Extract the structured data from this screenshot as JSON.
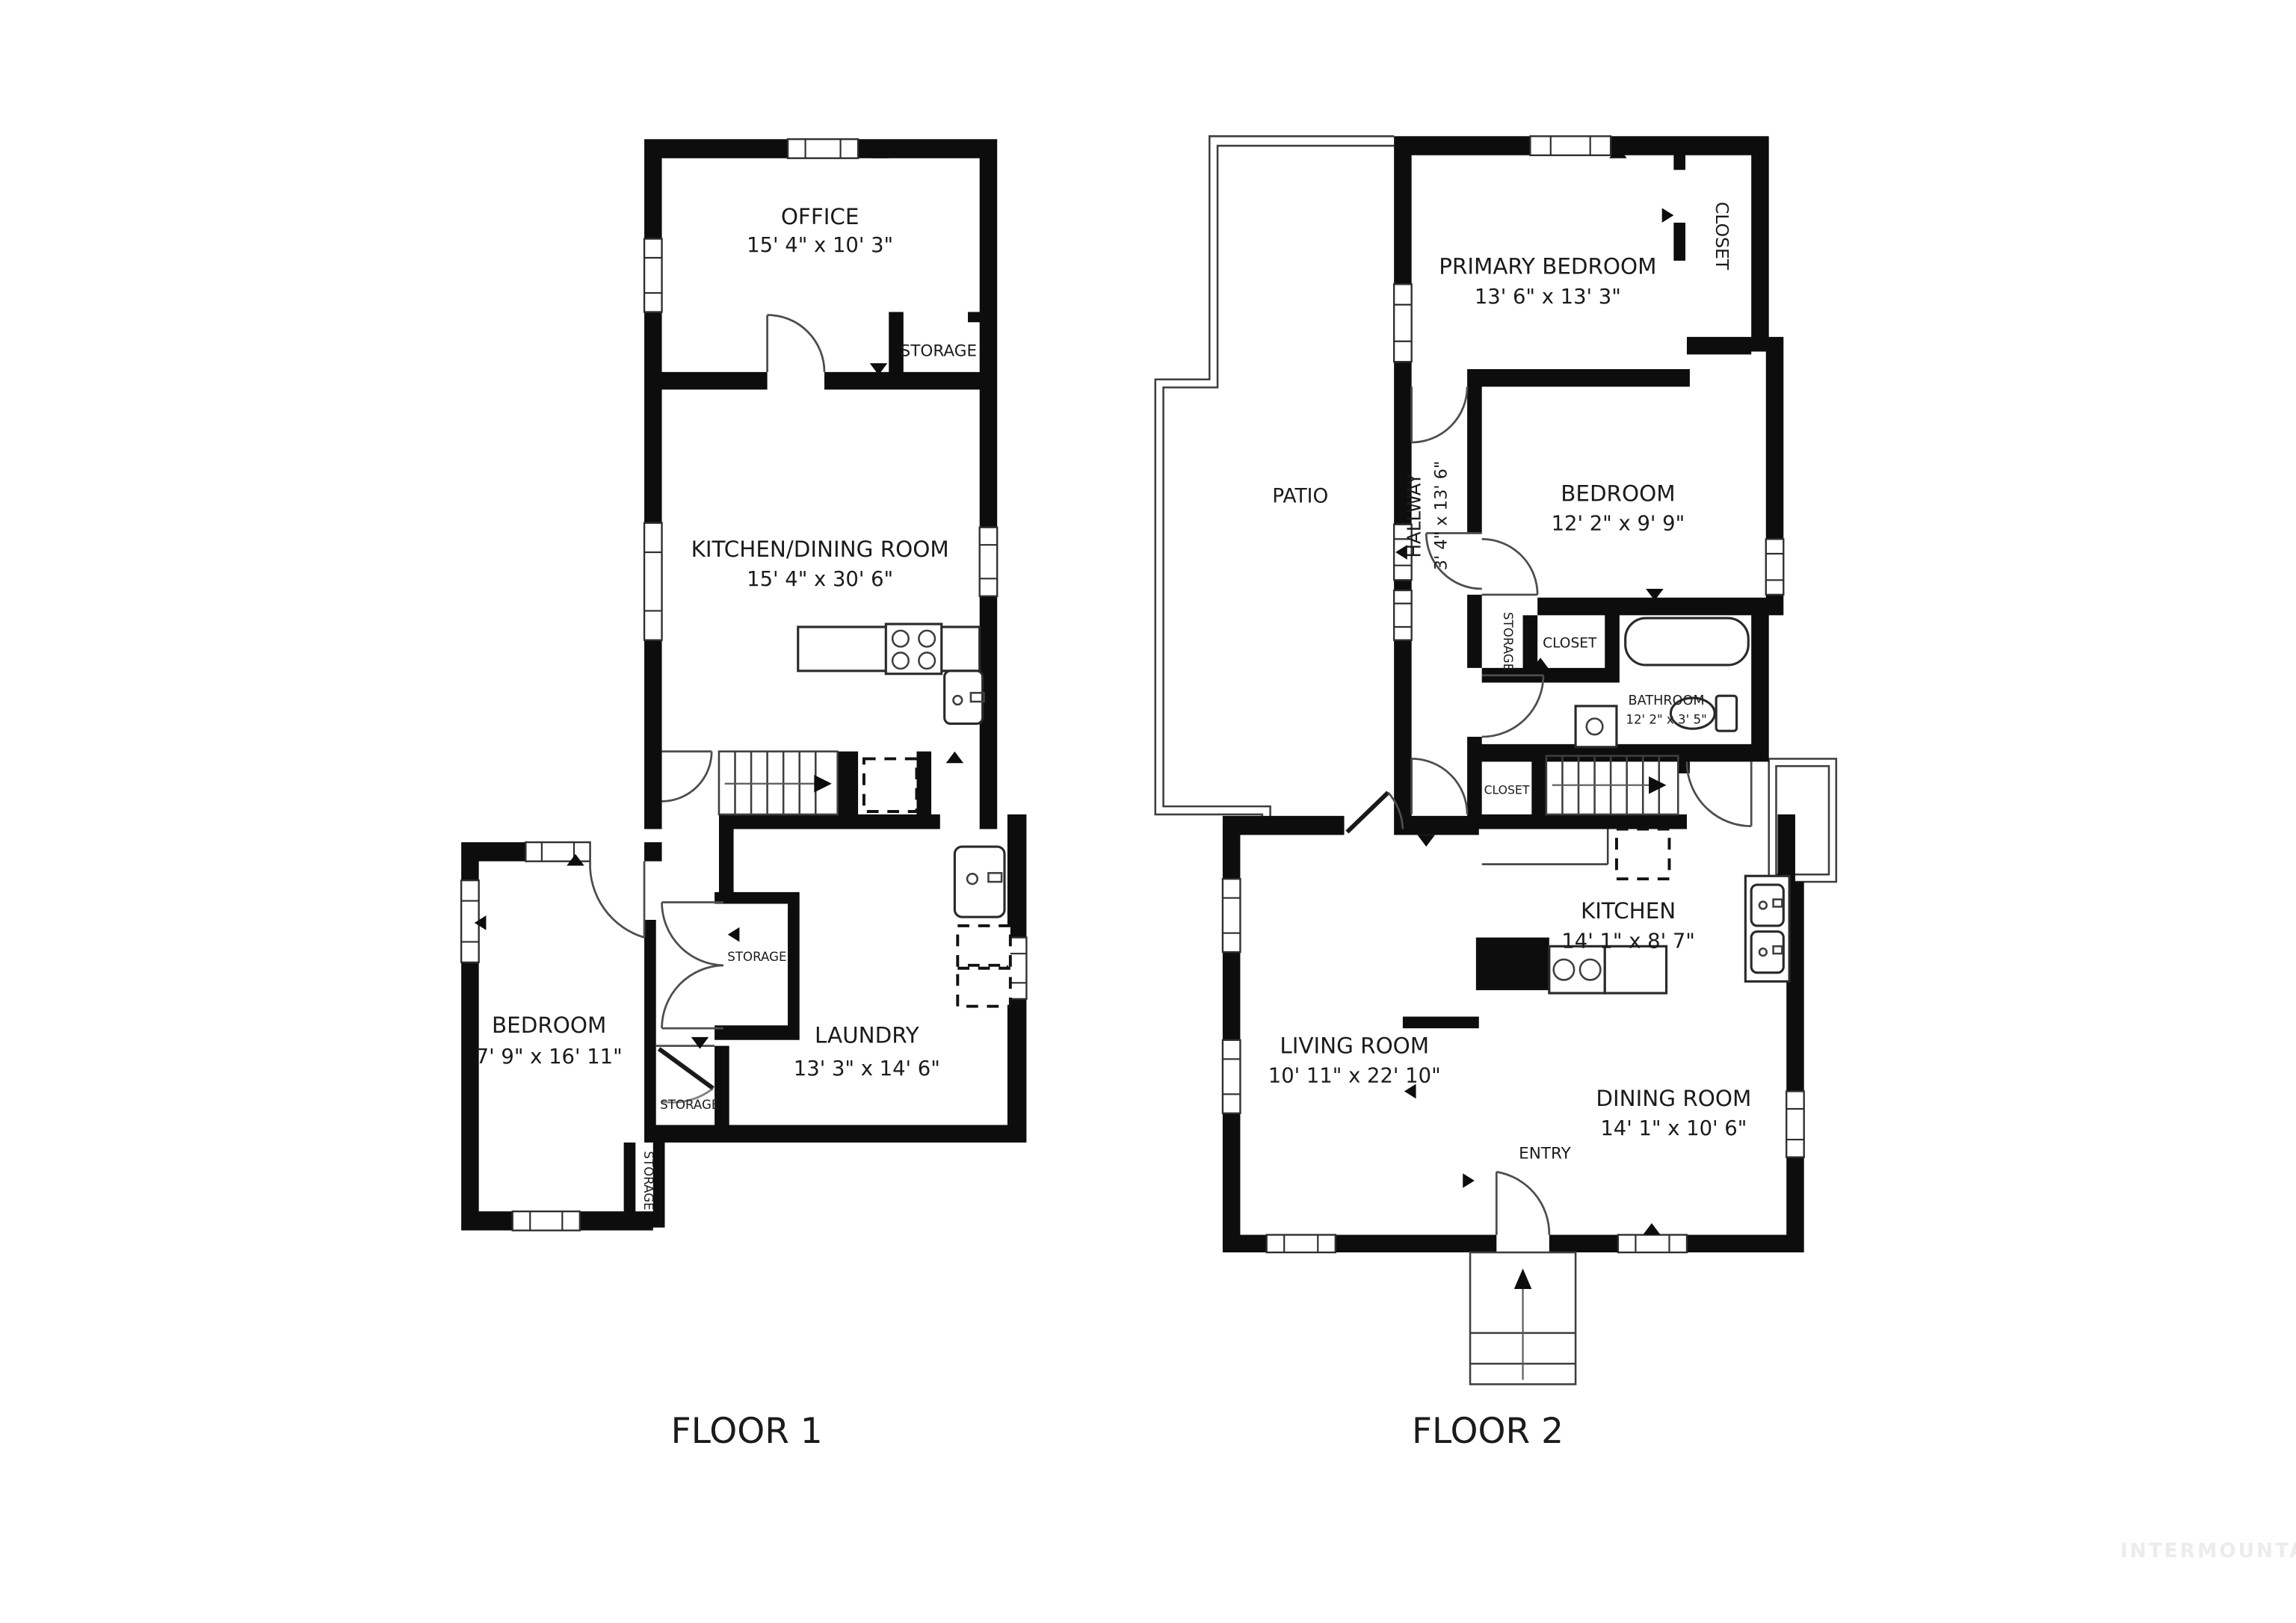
{
  "document": {
    "type": "floorplan",
    "background": "#ffffff"
  },
  "floor1": {
    "label": "FLOOR 1",
    "office": {
      "name": "OFFICE",
      "dims": "15' 4\" x 10' 3\""
    },
    "office_storage": "STORAGE",
    "kitchen_dining": {
      "name": "KITCHEN/DINING ROOM",
      "dims": "15' 4\" x 30' 6\""
    },
    "bedroom": {
      "name": "BEDROOM",
      "dims": "7' 9\" x 16' 11\""
    },
    "laundry": {
      "name": "LAUNDRY",
      "dims": "13' 3\" x 14' 6\""
    },
    "closet_storage": "STORAGE",
    "lower_storage": "STORAGE",
    "side_storage": "STORAGE"
  },
  "floor2": {
    "label": "FLOOR 2",
    "patio": "PATIO",
    "primary_bedroom": {
      "name": "PRIMARY BEDROOM",
      "dims": "13' 6\" x 13' 3\""
    },
    "primary_closet": "CLOSET",
    "hallway": {
      "name": "HALLWAY",
      "dims": "3' 4\" x 13' 6\""
    },
    "bedroom": {
      "name": "BEDROOM",
      "dims": "12' 2\" x 9' 9\""
    },
    "hall_storage": "STORAGE",
    "hall_closet": "CLOSET",
    "bathroom": {
      "name": "BATHROOM",
      "dims": "12' 2\" x 3' 5\""
    },
    "stair_closet": "CLOSET",
    "kitchen": {
      "name": "KITCHEN",
      "dims": "14' 1\" x 8' 7\""
    },
    "living_room": {
      "name": "LIVING ROOM",
      "dims": "10' 11\" x 22' 10\""
    },
    "dining_room": {
      "name": "DINING ROOM",
      "dims": "14' 1\" x 10' 6\""
    },
    "entry": "ENTRY"
  },
  "watermark": "INTERMOUNTAIN",
  "colors": {
    "wall": "#0d0d0d",
    "text": "#1b1b1b",
    "watermark": "#ececec",
    "background": "#ffffff"
  }
}
